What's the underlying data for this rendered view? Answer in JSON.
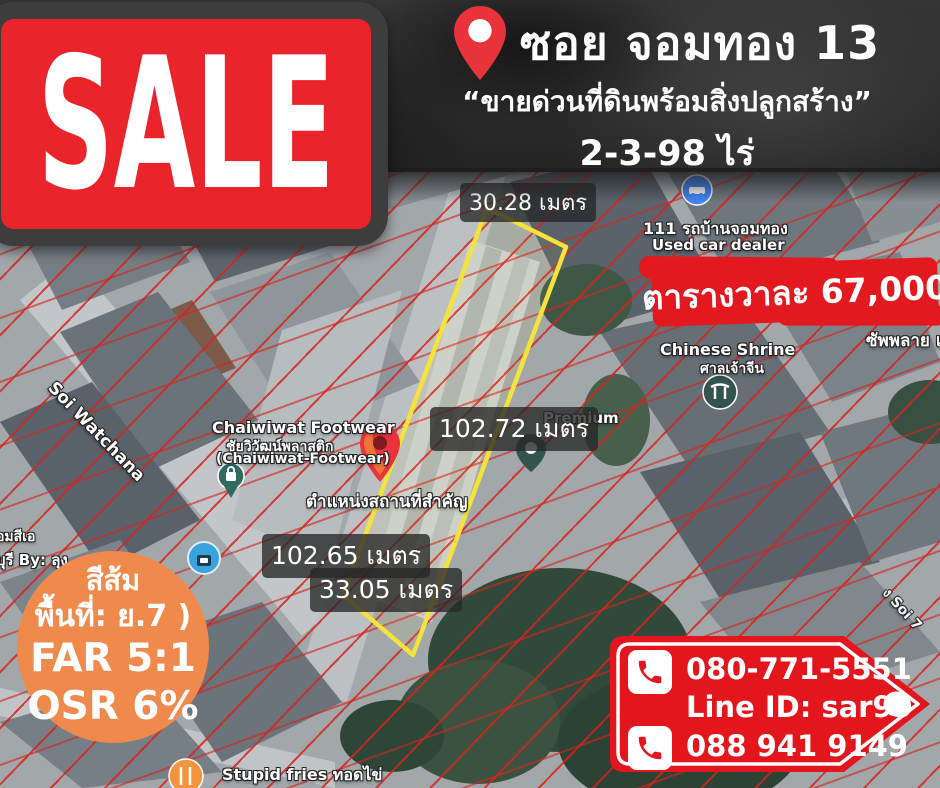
{
  "sale": {
    "label": "SALE"
  },
  "header": {
    "title": "ซอย จอมทอง 13",
    "subtitle": "“ขายด่วนที่ดินพร้อมสิ่งปลูกสร้าง”",
    "area": "2-3-98 ไร่"
  },
  "price": {
    "label": "ตารางวาละ 67,000"
  },
  "measurements": {
    "top": "30.28 เมตร",
    "east": "102.72 เมตร",
    "west": "102.65 เมตร",
    "south": "33.05 เมตร"
  },
  "pin_caption": "ตำแหน่งสถานที่สำคัญ",
  "zoning": {
    "line1": "สีส้ม",
    "line2": "พื้นที่: ย.7 )",
    "line3": "FAR 5:1",
    "line4": "OSR 6%"
  },
  "contact": {
    "phone1": "080-771-5551",
    "line_id": "Line ID: sar99",
    "phone2": "088 941 9149"
  },
  "map": {
    "soi_watchana": "Soi Watchana",
    "chaiwiwat_en": "Chaiwiwat Footwear",
    "chaiwiwat_th": "ชัยวิวัฒน์พลาสติก",
    "chaiwiwat_sub": "(Chaiwiwat-Footwear)",
    "premium": "Premium",
    "used_car_th": "111 รถบ้านจอมทอง",
    "used_car_en": "Used car dealer",
    "shrine_en": "Chinese Shrine",
    "shrine_th": "ศาลเจ้าจีน",
    "supply": "ซัพพลาย แอ",
    "left_label1": "อมสีเอ",
    "left_label2": "บุรี By: ลุง",
    "fries": "Stupid fries ทอดไข่",
    "soi7": "ง Soi 7"
  },
  "colors": {
    "accent_red": "#e2161c",
    "sale_red": "#e9242b",
    "orange": "#ef8a4c",
    "plot_outline": "#f3e33c",
    "cadastral_red": "#d6241e"
  }
}
